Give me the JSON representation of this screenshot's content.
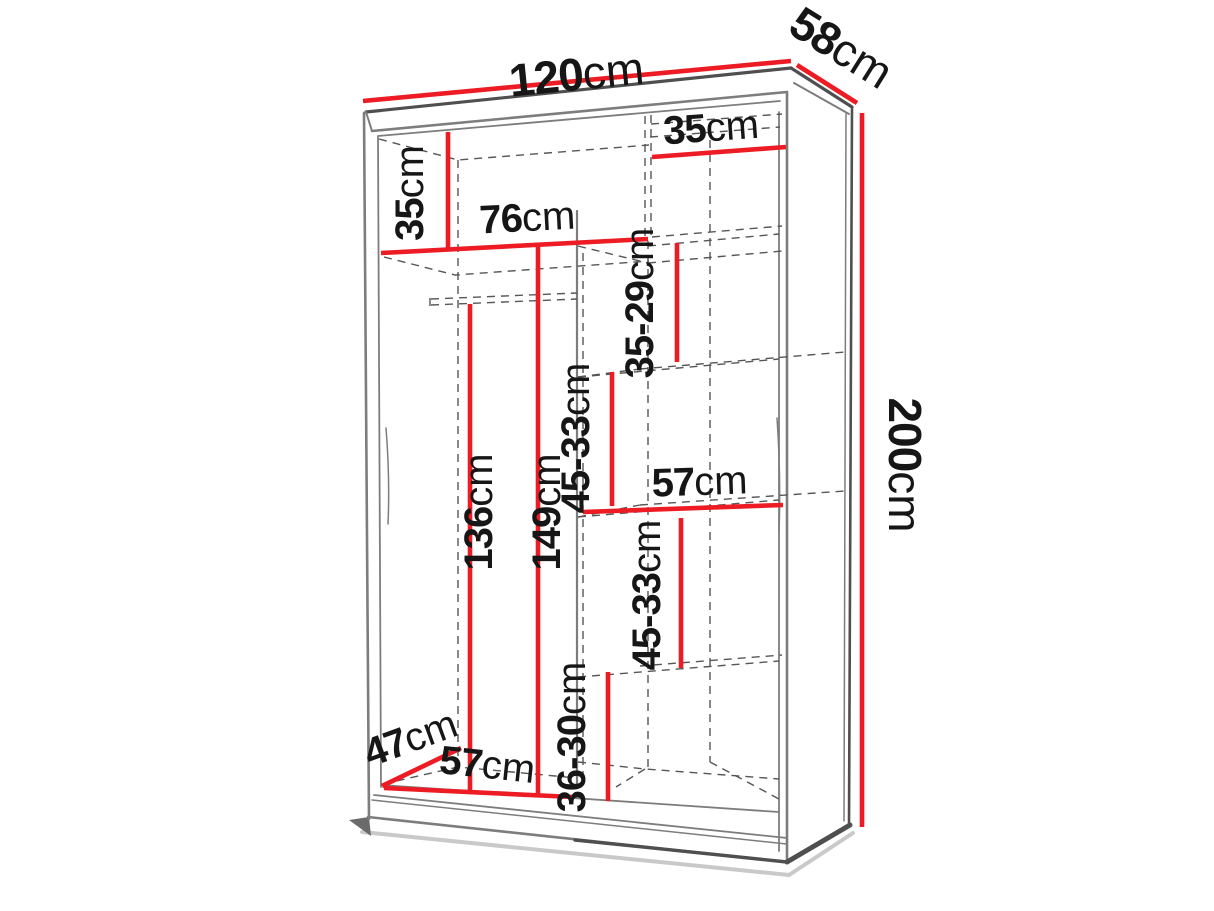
{
  "diagram": {
    "kind": "wardrobe-dimension-diagram",
    "unit": "cm",
    "colors": {
      "dimension": "#ed1c24",
      "outline": "#7d7d7d",
      "hidden_edges": "#565656",
      "text": "#161616",
      "background": "#ffffff"
    },
    "overall": {
      "width": "120",
      "depth": "58",
      "height": "200"
    },
    "measurements": [
      {
        "name": "overall-width",
        "value": "120",
        "unit": "cm"
      },
      {
        "name": "overall-depth",
        "value": "58",
        "unit": "cm"
      },
      {
        "name": "overall-height",
        "value": "200",
        "unit": "cm"
      },
      {
        "name": "top-left-compartment-height",
        "value": "35",
        "unit": "cm"
      },
      {
        "name": "left-shelf-width",
        "value": "76",
        "unit": "cm"
      },
      {
        "name": "top-right-compartment-width",
        "value": "35",
        "unit": "cm"
      },
      {
        "name": "right-shelf-gap-1",
        "value": "35-29",
        "unit": "cm"
      },
      {
        "name": "right-shelf-gap-2",
        "value": "45-33",
        "unit": "cm"
      },
      {
        "name": "hanging-space-height",
        "value": "136",
        "unit": "cm"
      },
      {
        "name": "left-compartment-height",
        "value": "149",
        "unit": "cm"
      },
      {
        "name": "right-shelf-width",
        "value": "57",
        "unit": "cm"
      },
      {
        "name": "right-shelf-gap-3",
        "value": "45-33",
        "unit": "cm"
      },
      {
        "name": "right-bottom-gap",
        "value": "36-30",
        "unit": "cm"
      },
      {
        "name": "interior-depth",
        "value": "47",
        "unit": "cm"
      },
      {
        "name": "left-compartment-width",
        "value": "57",
        "unit": "cm"
      }
    ]
  }
}
